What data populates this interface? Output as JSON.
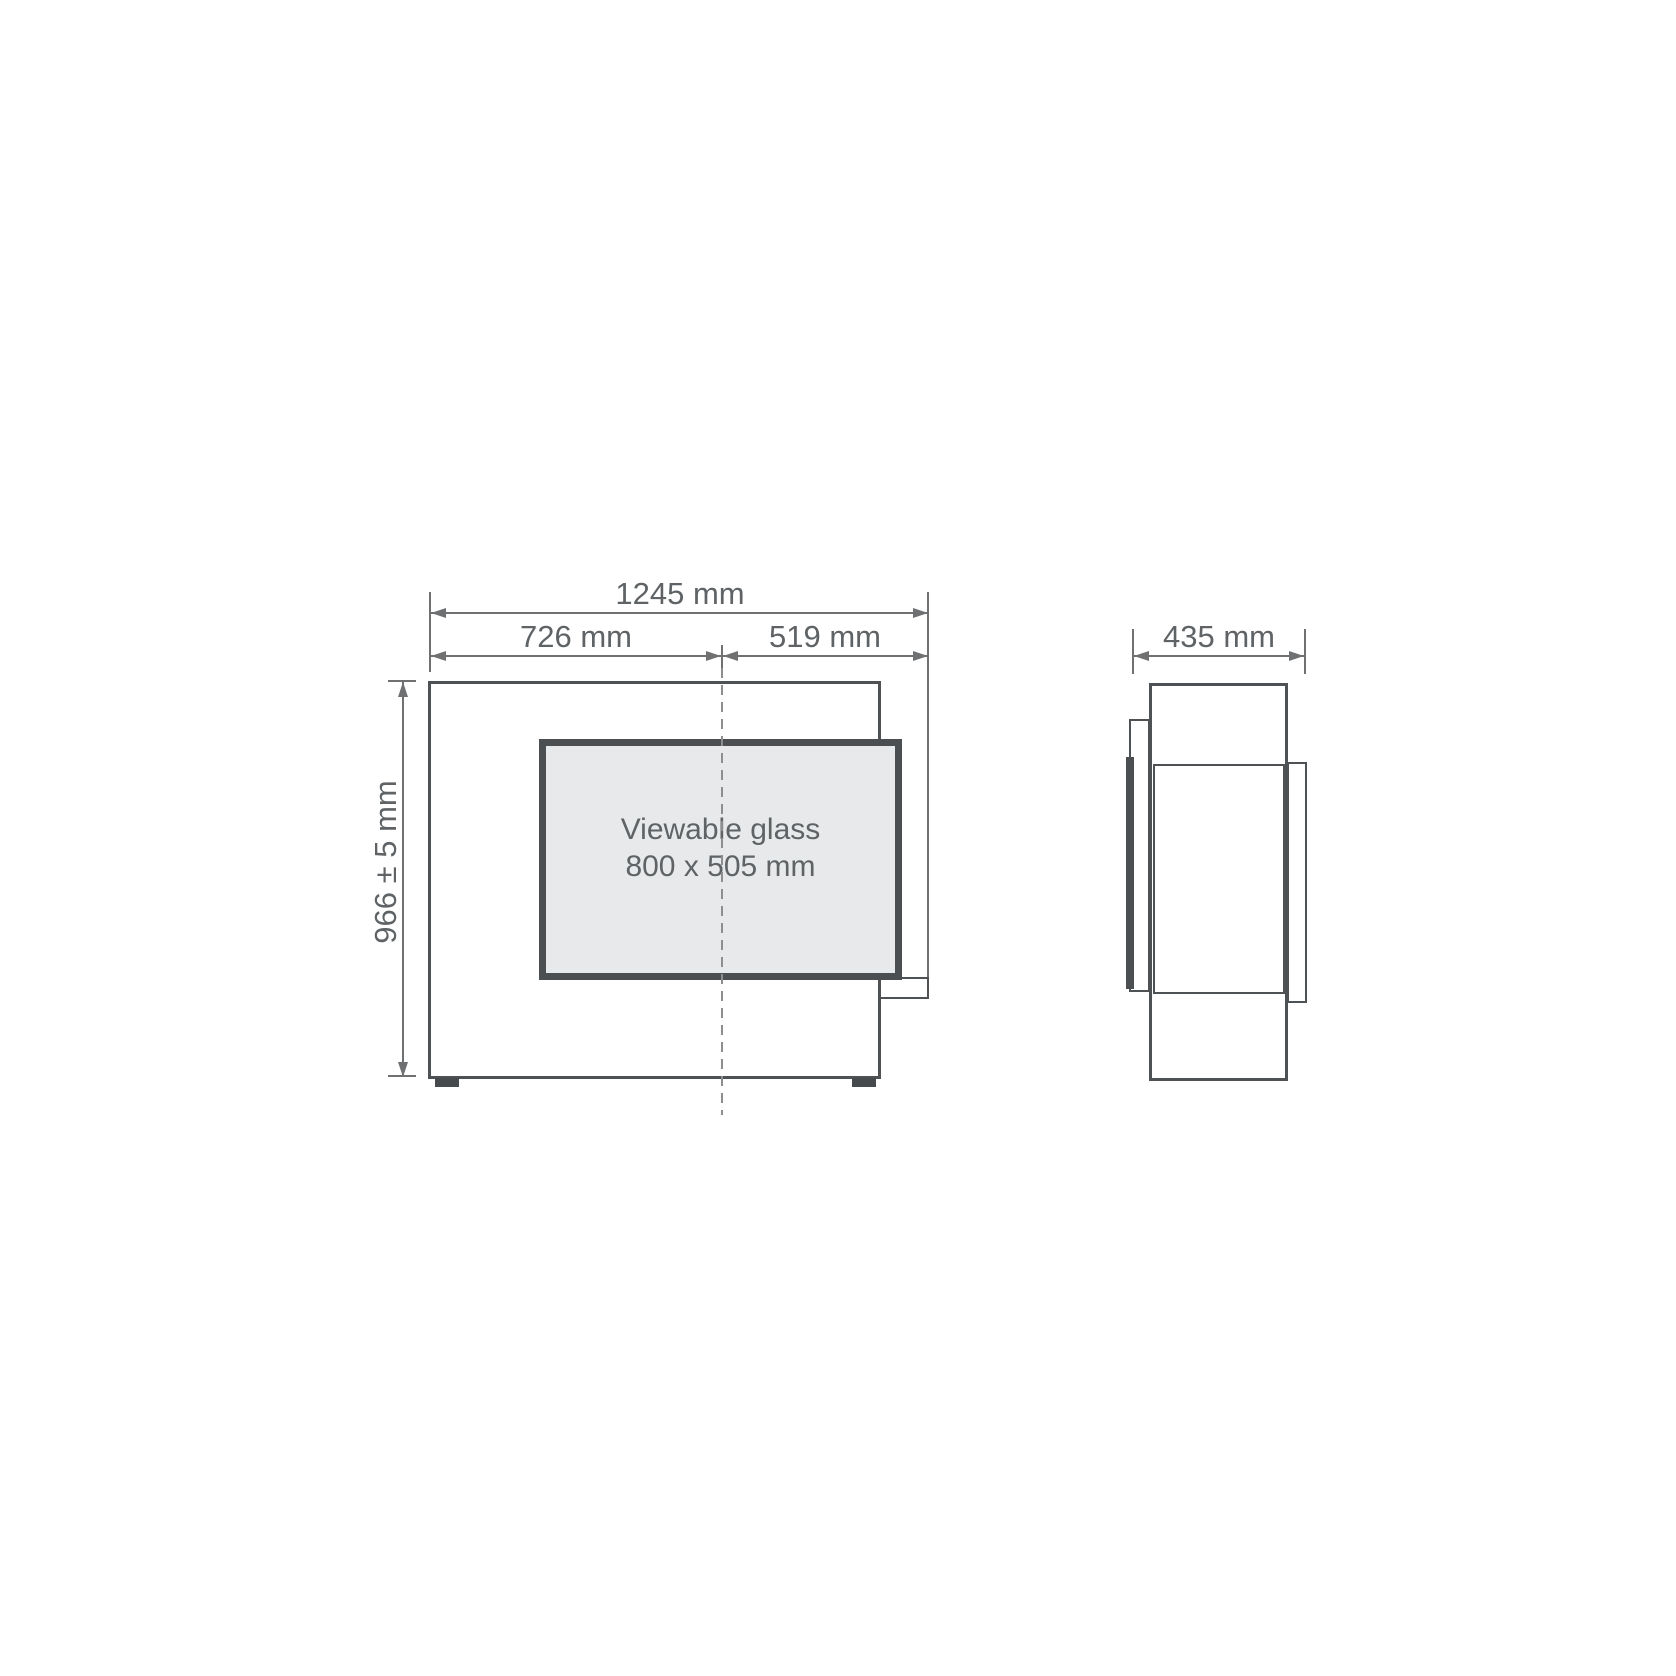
{
  "drawing": {
    "front_view": {
      "total_width_label": "1245 mm",
      "left_width_label": "726 mm",
      "right_width_label": "519 mm",
      "height_label": "966 ± 5 mm",
      "glass_caption_line1": "Viewable glass",
      "glass_caption_line2": "800 x 505 mm"
    },
    "side_view": {
      "depth_label": "435 mm"
    }
  },
  "colors": {
    "line": "#4f5254",
    "dim": "#6e7072",
    "glass-border": "#4c4f51",
    "glass-fill": "#e7e9ea",
    "text": "#5f6365",
    "dash": "#8c8e90",
    "background": "#ffffff"
  }
}
